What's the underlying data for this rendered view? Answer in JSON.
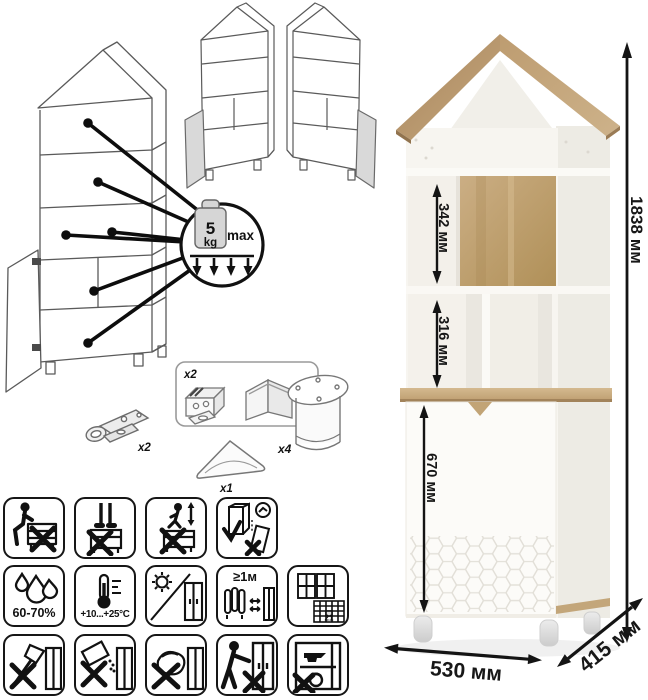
{
  "sheet": {
    "background": "#ffffff",
    "accent": "#111111",
    "oak_color": "#c0a175"
  },
  "load_limit": {
    "value": "5",
    "unit": "kg",
    "qualifier": "max"
  },
  "hardware": {
    "hinge_qty": "x2",
    "bracket_qty": "x2",
    "leg_qty": "x4",
    "handle_qty": "x1"
  },
  "care": {
    "humidity_range": "60-70%",
    "temperature_range": "+10...+25°C",
    "min_distance": "≥1м",
    "calendar_day": "21"
  },
  "dimensions": {
    "total_height": "1838 мм",
    "upper_niche_height": "342 мм",
    "middle_niche_height": "316 мм",
    "door_section_height": "670 мм",
    "width": "530 мм",
    "depth": "415 мм"
  },
  "warning_icons": {
    "row1": [
      "no-sitting",
      "no-standing",
      "no-jumping",
      "anchor-to-wall"
    ],
    "row2": [
      "humidity-range",
      "temperature-range",
      "avoid-direct-sunlight",
      "keep-1m-from-heaters",
      "ventilate-room"
    ],
    "row3": [
      "no-axe-impacts",
      "no-abrasive-cleaners",
      "no-wet-sponge",
      "no-dragging",
      "no-overloading"
    ]
  }
}
